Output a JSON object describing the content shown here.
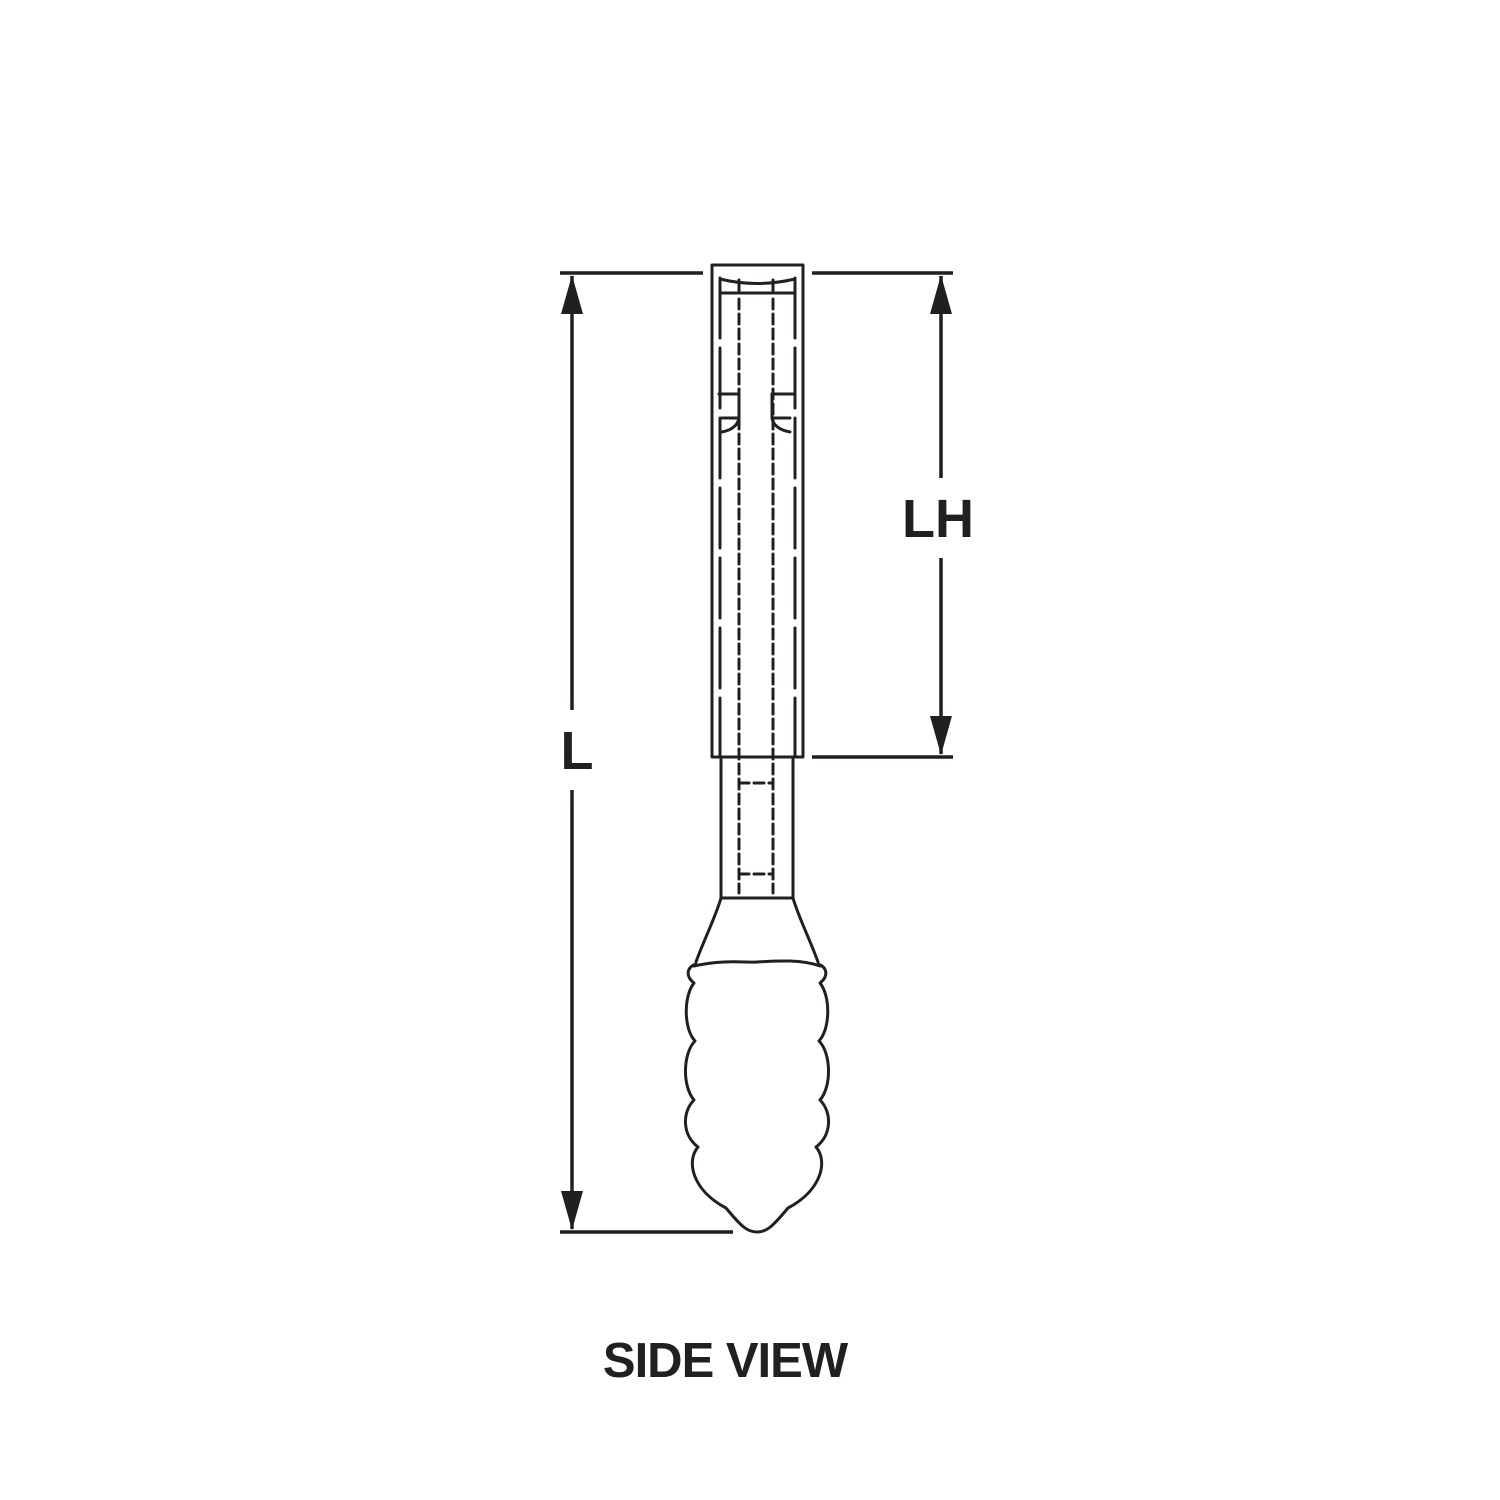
{
  "diagram": {
    "caption": "SIDE VIEW",
    "dimension_labels": [
      {
        "id": "overall-length",
        "text": "L"
      },
      {
        "id": "upper-section-length",
        "text": "LH"
      }
    ],
    "colors": {
      "line": "#231f20",
      "background": "#ffffff",
      "label_background": "#ffffff"
    }
  }
}
